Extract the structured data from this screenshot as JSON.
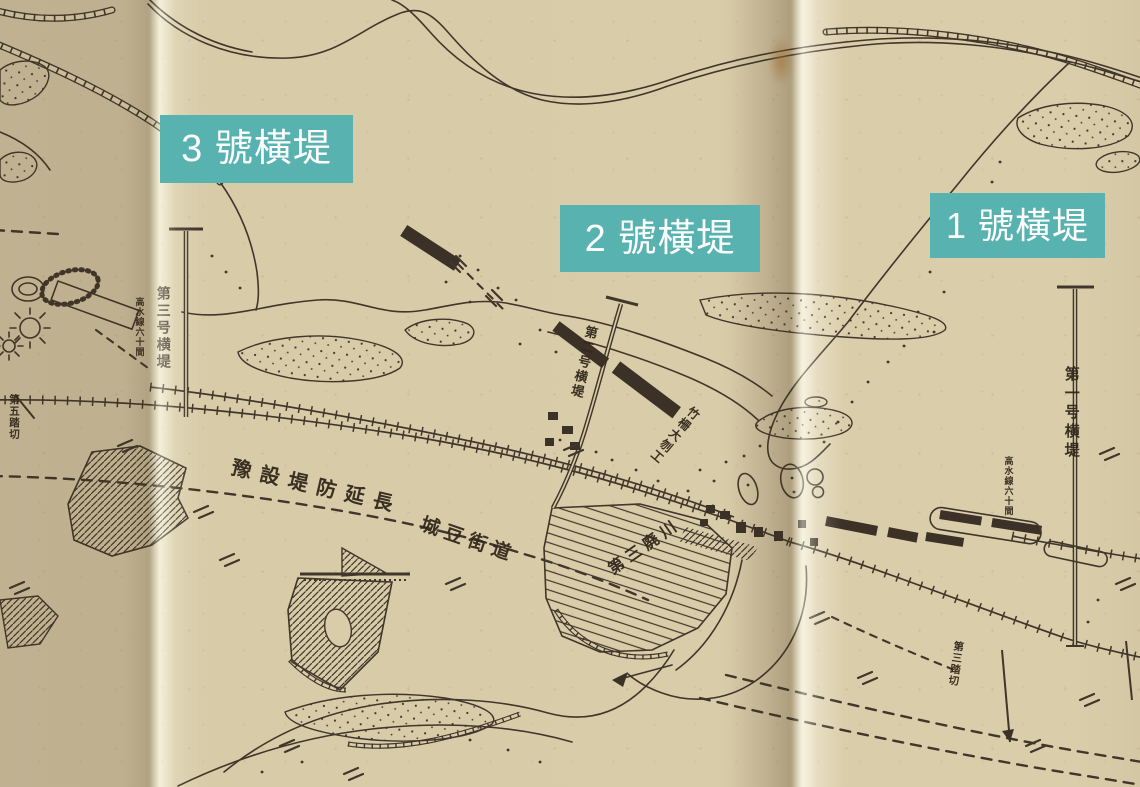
{
  "image_type": "scanned-historical-river-map",
  "overlay_labels": [
    {
      "id": "dike-3",
      "text": "3 號橫堤"
    },
    {
      "id": "dike-2",
      "text": "2 號橫堤"
    },
    {
      "id": "dike-1",
      "text": "1 號橫堤"
    }
  ],
  "map_text": {
    "dike3_name": "第三号横堤",
    "dike3_note": "高水線六十間",
    "dike2_name": "第二号横堤",
    "dike1_name": "第一号横堤",
    "dike1_note": "高水線六十間",
    "crossing_left": "第五踏切",
    "crossing_right": "第三踏切",
    "embankment_note": "豫設堤防延長",
    "road_name": "城豆街道",
    "works_note": "竹柵大刎工",
    "old_channel_note": "第三廃川"
  },
  "colors": {
    "label_background": "#58b2b0",
    "label_text": "#fdfdfd",
    "paper": "#d8cca9",
    "paper_fold_highlight": "#efe7cd",
    "ink": "#40362a"
  }
}
